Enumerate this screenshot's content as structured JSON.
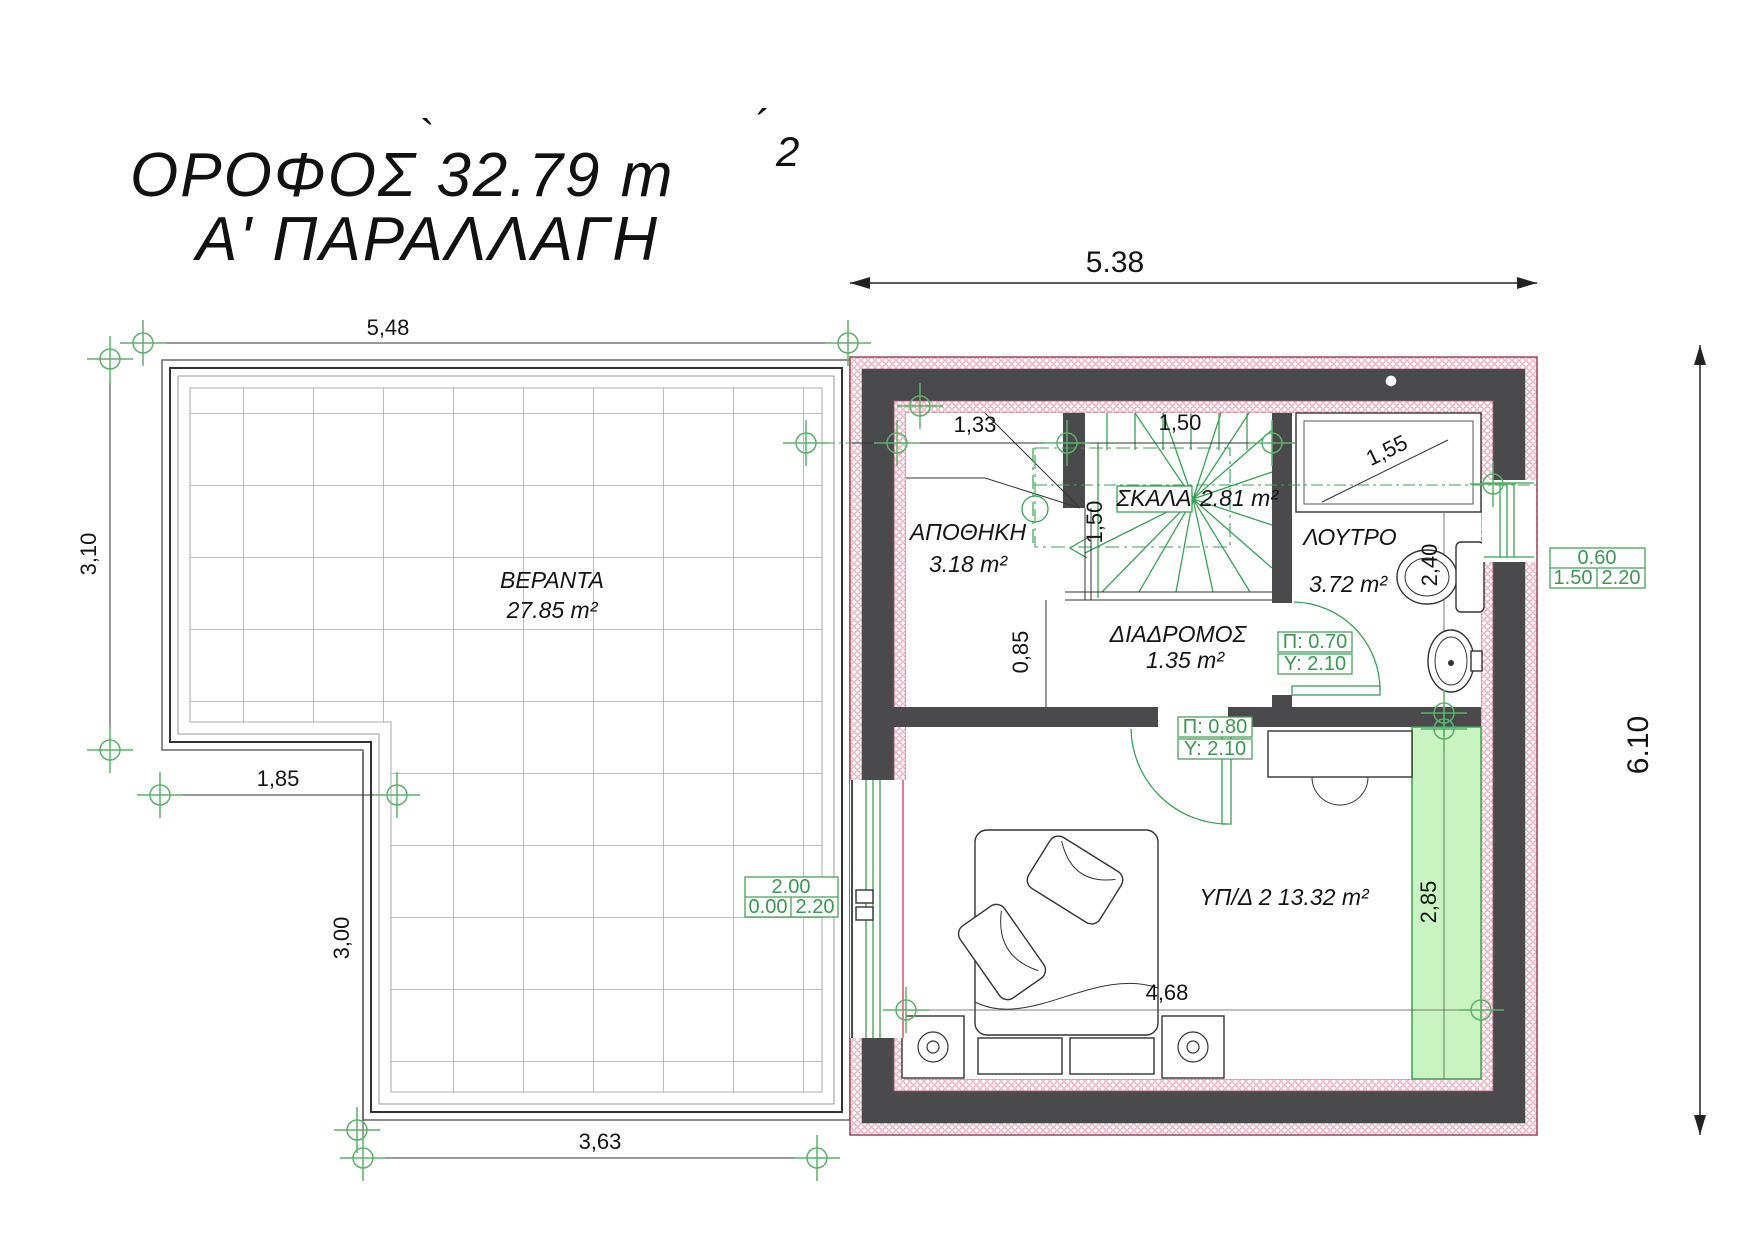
{
  "colors": {
    "wall": "#4a4a4d",
    "insulation_pink": "#e8a8ba",
    "accent_green": "#3aa055",
    "strip_green_fill": "#c9f3c1",
    "window_red": "#cc4040",
    "dim_text": "#1a1a1a",
    "tile_grid": "#bcbcbc"
  },
  "title": {
    "line1": "ΟΡΟΦΟΣ 32.79 m",
    "line1_sup": "2",
    "accent_grave": "`",
    "accent_acute": "´",
    "line2": "Α' ΠΑΡΑΛΛΑΓΗ"
  },
  "rooms": {
    "veranda": {
      "name": "ΒΕΡΑΝΤΑ",
      "area": "27.85 m²"
    },
    "storage": {
      "name": "ΑΠΟΘΗΚΗ",
      "area": "3.18 m²"
    },
    "stairs": {
      "name": "ΣΚΑΛΑ",
      "area": "2.81 m²"
    },
    "bathroom": {
      "name": "ΛΟΥΤΡΟ",
      "area": "3.72 m²"
    },
    "hallway": {
      "name": "ΔΙΑΔΡΟΜΟΣ",
      "area": "1.35 m²"
    },
    "bedroom": {
      "name_area": "ΥΠ/Δ 2 13.32 m²"
    }
  },
  "dims": {
    "building_width": "5.38",
    "building_height": "6.10",
    "veranda_top": "5,48",
    "veranda_left": "3,10",
    "step_width": "1,85",
    "step_depth": "3,00",
    "veranda_bottom": "3,63",
    "storage_top": "1,33",
    "stair_top": "1,50",
    "stair_side": "1,50",
    "hall": "0,85",
    "bath": "2,40",
    "shower": "1,55",
    "closet": "2,85",
    "bedroom": "4,68"
  },
  "door_specs": {
    "bathroom": {
      "width": "Π: 0.70",
      "height": "Υ: 2.10"
    },
    "bedroom": {
      "width": "Π: 0.80",
      "height": "Υ: 2.10"
    }
  },
  "window_specs": {
    "right_window": {
      "width": "0.60",
      "sill": "1.50",
      "height": "2.20"
    },
    "balcony_door": {
      "width": "2.00",
      "sill": "0.00",
      "height": "2.20"
    }
  }
}
